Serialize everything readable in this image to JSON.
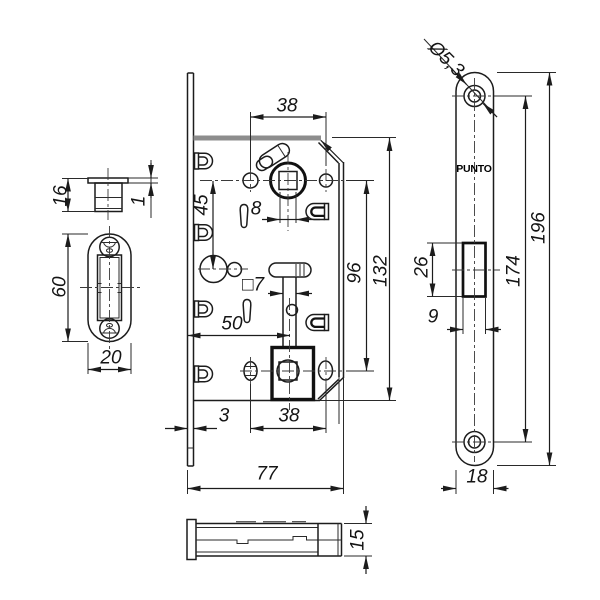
{
  "brand": "PUNTO",
  "dims": {
    "d38_top": "38",
    "d8": "8",
    "d45": "45",
    "d7sq": "□7",
    "d50": "50",
    "d96": "96",
    "d132": "132",
    "d3": "3",
    "d38_bottom": "38",
    "d77": "77",
    "d16": "16",
    "d1": "1",
    "d60": "60",
    "d20": "20",
    "d5_3": "Ø5,3",
    "d26": "26",
    "d9": "9",
    "d174": "174",
    "d196": "196",
    "d18": "18",
    "d15": "15"
  }
}
